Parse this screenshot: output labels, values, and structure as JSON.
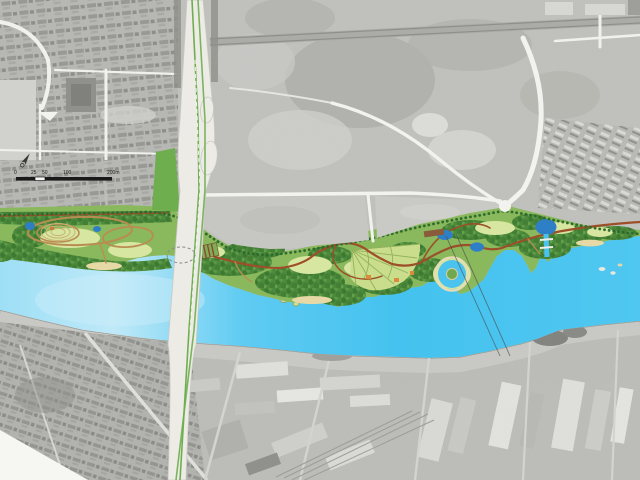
{
  "map": {
    "kind": "riverside-park-landscape-masterplan-over-aerial-photo",
    "features": [
      "aerial photo background",
      "residential district north-west",
      "open fields north-east",
      "railway corridor",
      "housing estate east",
      "riverside arterial road",
      "highway bridge and interchange",
      "riverside park band with paths, lawns and tree canopy",
      "fan-shaped garden",
      "ponds and lagoon",
      "river",
      "south bank quay",
      "industrial district south",
      "residential district south-west",
      "power lines crossing river"
    ]
  },
  "scale_bar": {
    "labels": [
      "0",
      "25",
      "50",
      "100",
      "200m"
    ],
    "unit": "m"
  },
  "north_arrow": {
    "icon": "compass-north-arrow"
  },
  "colors": {
    "aerial_base": "#c5c5c1",
    "aerial_shadow": "#9a9a96",
    "aerial_light": "#dcdcd8",
    "road_white": "#f2f2ee",
    "rail_gray": "#a3a39f",
    "water": "#49c2ef",
    "water_light": "#aee3f7",
    "pond": "#2f7fc6",
    "quay": "#c9c9c5",
    "park_base": "#8ab85c",
    "canopy": "#4d8a3c",
    "canopy_dark": "#3c7a31",
    "lawn": "#d7e6a0",
    "sand": "#e6d9a6",
    "path_tan": "#b98d52",
    "path_red": "#9c4f28",
    "street_tree": "#2e6b2c",
    "bridge_deck": "#ecebe6",
    "median_green": "#6fae4f",
    "scale_ink": "#1a1a1a"
  }
}
